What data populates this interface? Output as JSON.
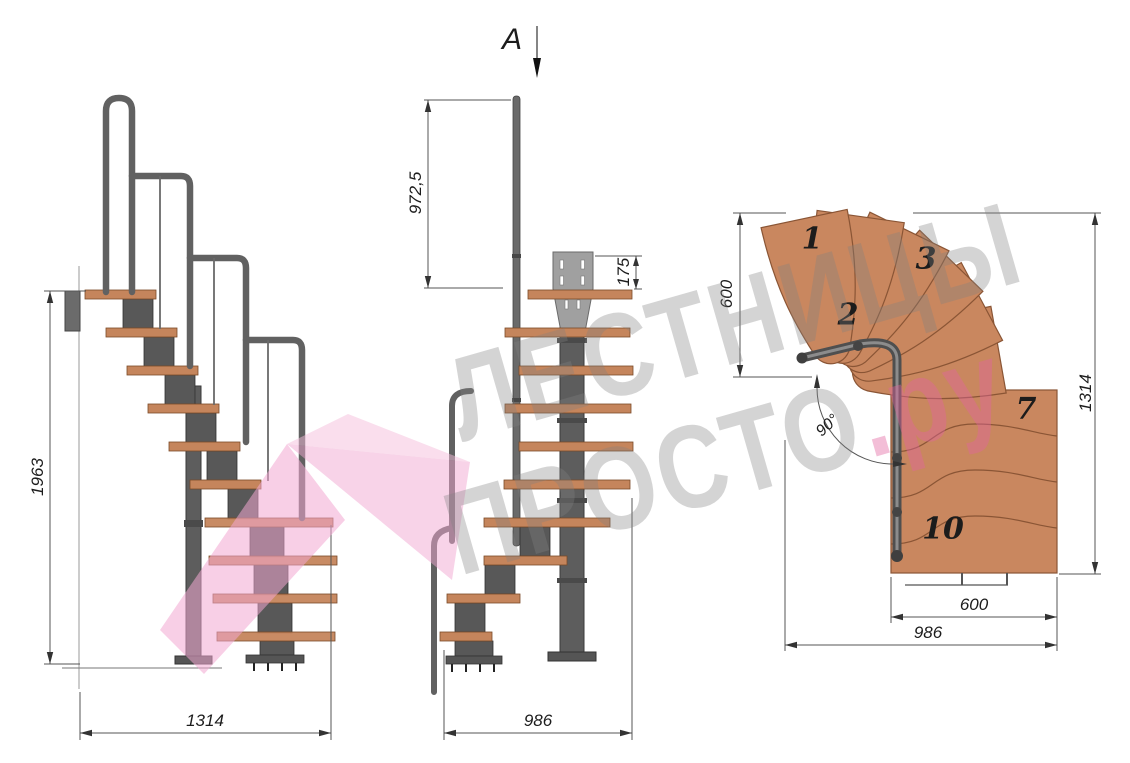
{
  "section_marker": {
    "label": "A"
  },
  "views": {
    "side": {
      "dims": {
        "height": "1963",
        "width": "1314"
      }
    },
    "front": {
      "dims": {
        "rail_height": "972,5",
        "plate_offset": "175",
        "width": "986"
      }
    },
    "plan": {
      "dims": {
        "left": "600",
        "right": "1314",
        "bottom_inner": "600",
        "bottom_outer": "986",
        "angle": "90°"
      },
      "step_numbers": [
        "1",
        "2",
        "3",
        "7",
        "10"
      ]
    }
  },
  "watermark": {
    "line1": "ЛЕСТНИЦЫ",
    "line2": "ПРОСТО",
    "line2_suffix": ".ру"
  },
  "colors": {
    "wood": "#c5855c",
    "wood_outline": "#8a5535",
    "metal_dark": "#4f4f4f",
    "metal_mid": "#6a6a6a",
    "plate": "#a0a0a0",
    "dim_line": "#555555",
    "watermark_gray": "rgba(128,128,128,0.34)",
    "watermark_pink": "rgba(242,167,209,0.5)"
  }
}
